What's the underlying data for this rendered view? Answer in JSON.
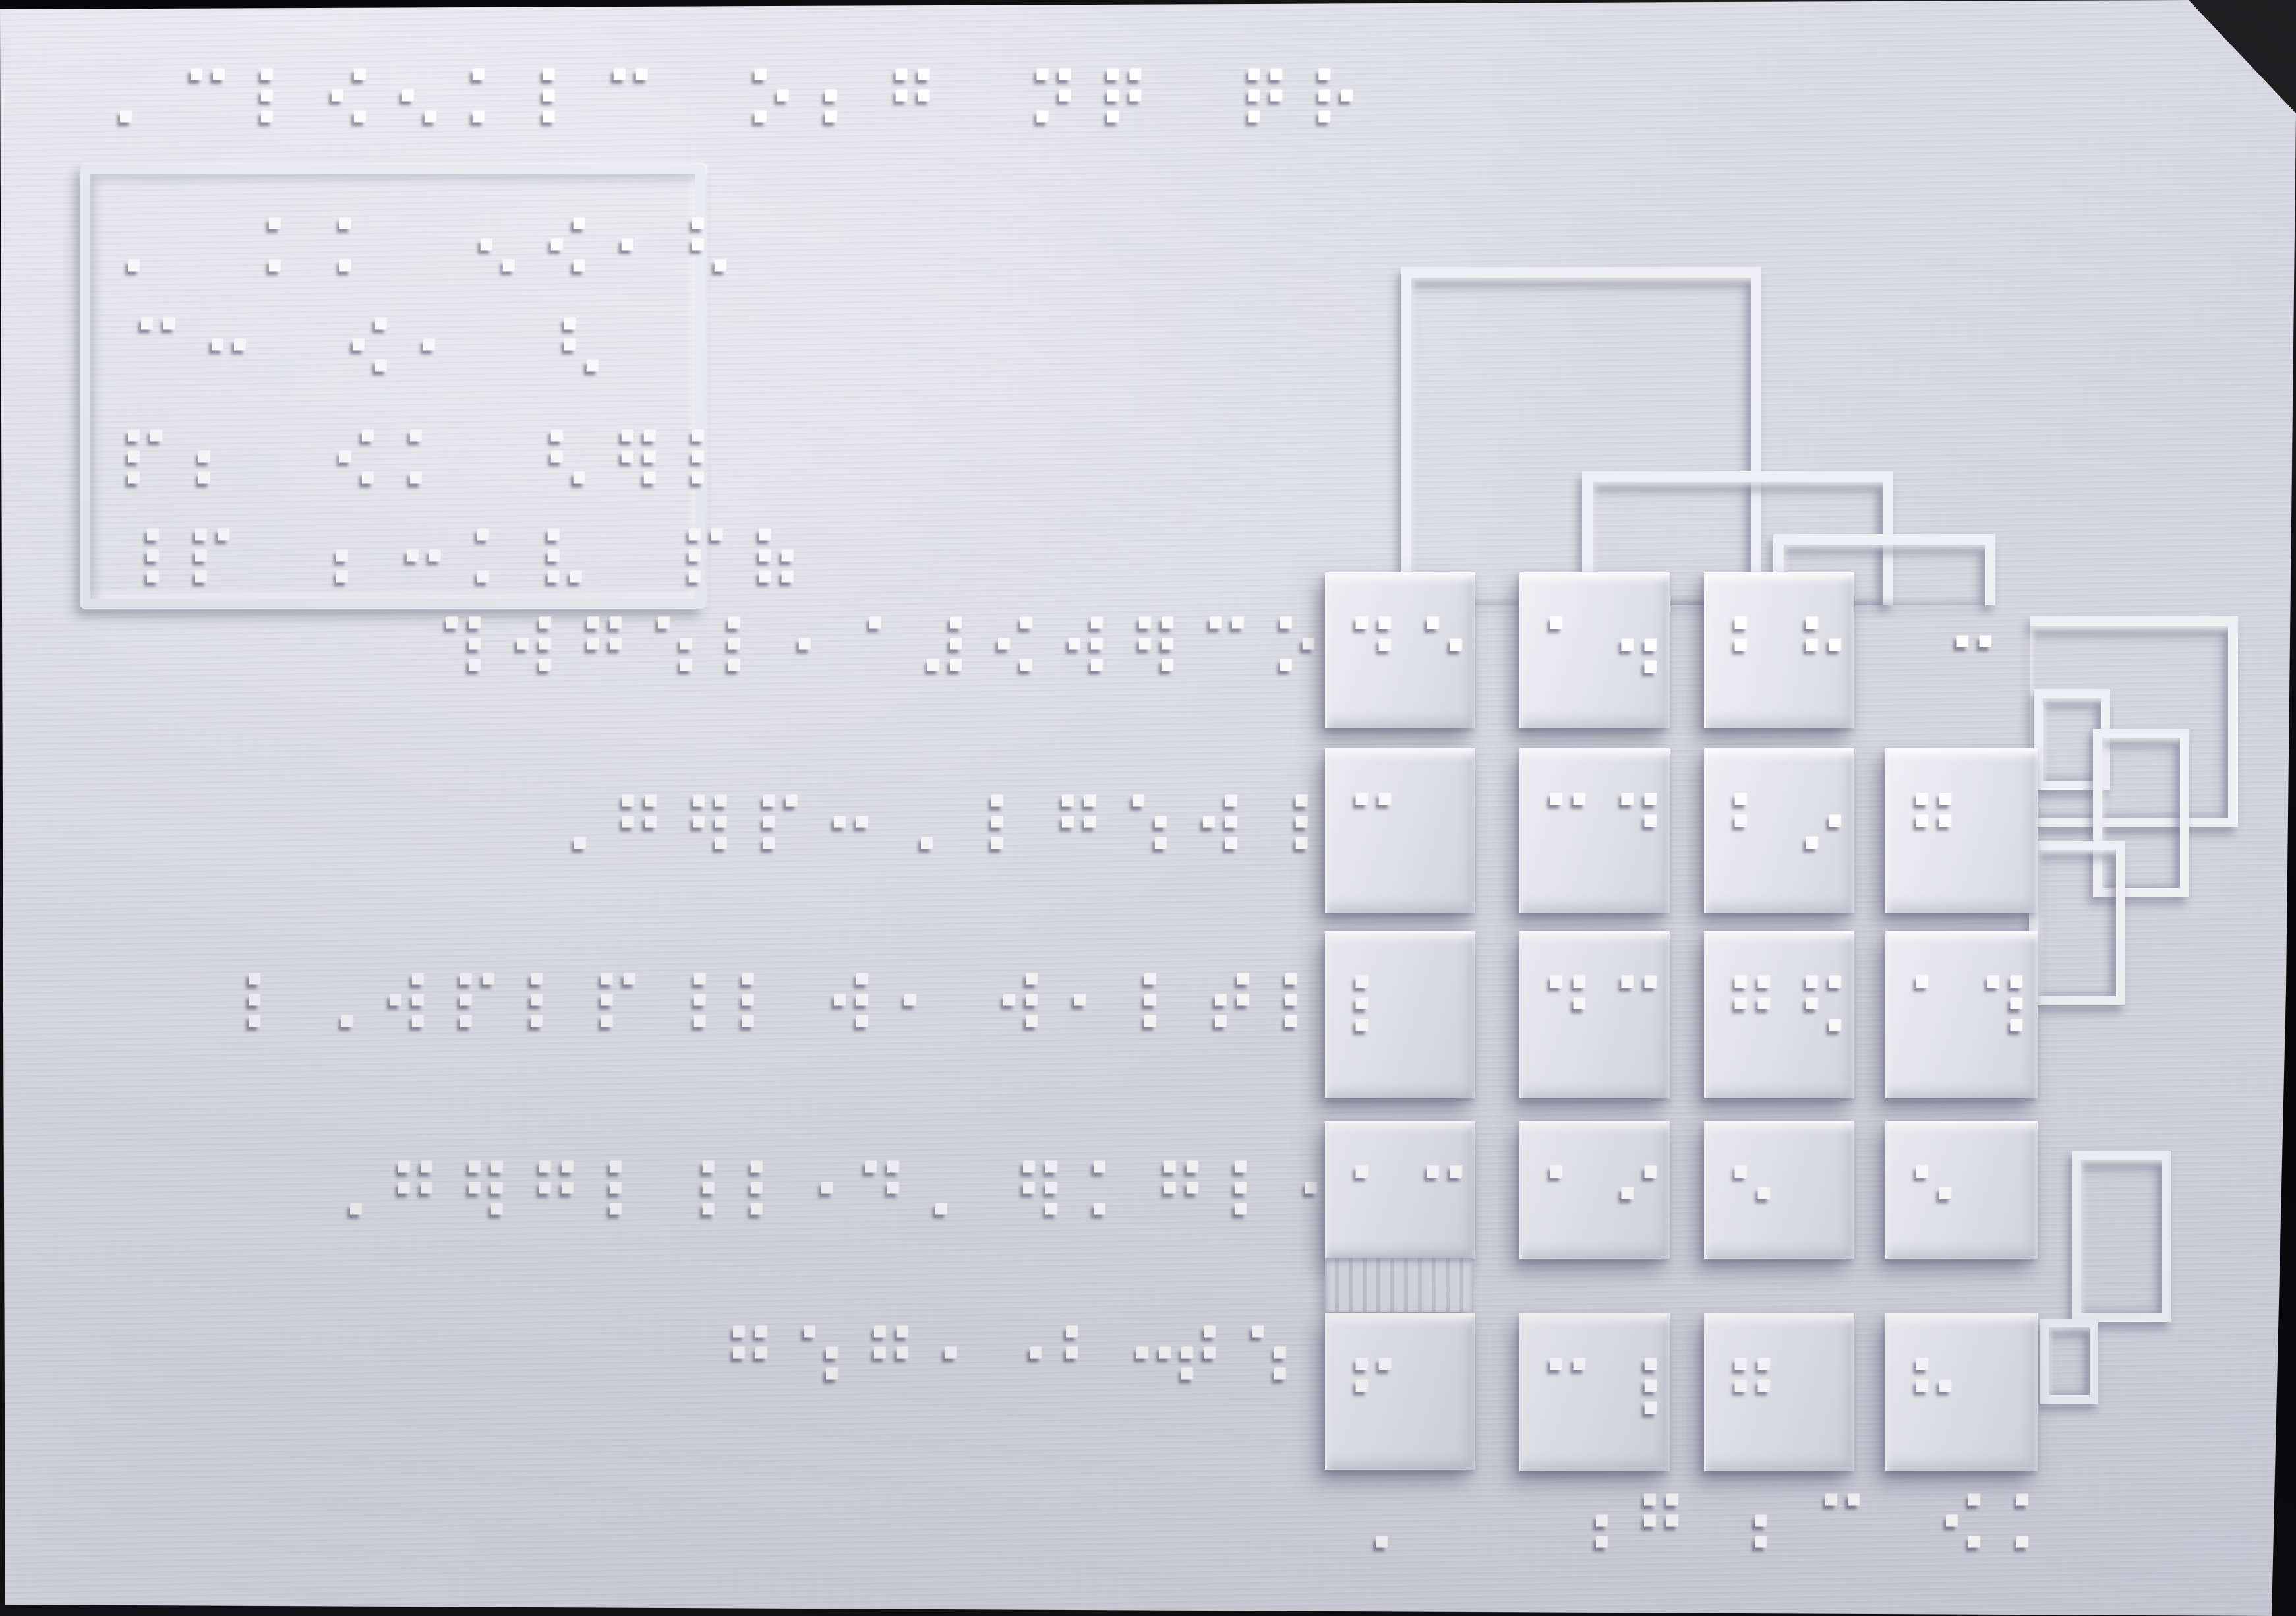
{
  "colors": {
    "background": "#070709",
    "plate": "#dedee6",
    "plate_highlight": "#ebebf1",
    "relief_ridge": "#eeeef5",
    "braille_dot": "#fdfdff",
    "cast_shadow": "#52526a"
  },
  "title": {
    "braille": "⠄⠉⠇⠪⠢⠅⠇⠉⠀⠕⠆⠛⠀⠝⠟⠀⠟⠗"
  },
  "info_box": {
    "lines": [
      "⠄⠀⠅⠅⠀⠢⠪⠂⠣",
      "⠉⠒⠀⠪⠂⠀⠣",
      "⠏⠆⠀⠪⠅⠀⠣⠻⠇",
      "⠸⠏⠀⠆⠒⠅⠧⠀⠏⠷"
    ]
  },
  "labels": {
    "rowA": {
      "g1": "⠹⠺⠛⠱⠇⠂⠁",
      "g2": "⠼⠪⠺⠻⠉⠕⠂"
    },
    "rowB": {
      "g1": "⠠⠛⠻⠏⠒",
      "g2": "⠄⠇⠛⠱⠺⠸⠇"
    },
    "rowC": {
      "g1": "⠇⠠⠺⠏⠇⠏⠸⠇",
      "g2": "⠺⠂",
      "g3": "⠺⠂⠇⠞⠇"
    },
    "rowD": {
      "g1": "⠠⠛⠻⠛⠇⠸⠇⠂",
      "g2": "⠙⠄",
      "g3": "⠻⠅⠛⠇⠂"
    },
    "rowE": {
      "g1": "⠛⠱⠛⠂",
      "g2": "⠂",
      "g3": "⠃⠒",
      "g4": "⠞⠱"
    }
  },
  "keypad": {
    "rows": [
      {
        "c1": "⠙⠑",
        "c2": "⠁⠲",
        "c3": "⠃⠓"
      },
      {
        "c1": "⠉",
        "c2": "⠉⠙",
        "c3": "⠃⠔",
        "c4": "⠛"
      },
      {
        "c1": "⠇",
        "c2": "⠙⠉",
        "c3": "⠛⠫",
        "c4": "⠁⠹"
      },
      {
        "c1": "⠁⠉",
        "c2": "⠁⠊",
        "c3": "⠑",
        "c4": "⠑"
      },
      {
        "c1": "⠋",
        "c2": "⠉⠸",
        "c3": "⠛",
        "c4": "⠓"
      }
    ],
    "row1_plate_dots": "⠒",
    "footer": [
      "⠄",
      "⠰⠛",
      "⠆⠉",
      "⠪⠅"
    ]
  }
}
